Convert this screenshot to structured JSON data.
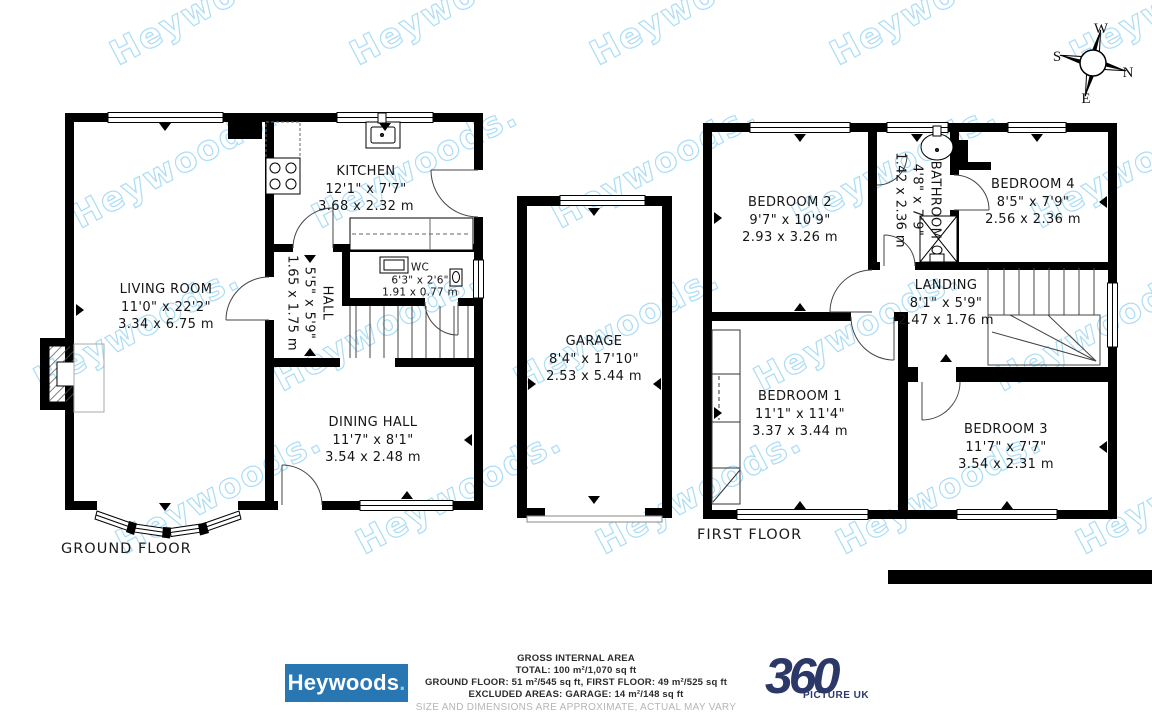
{
  "watermark": {
    "text": "Heywoods.",
    "color": "#aaddf5"
  },
  "compass": {
    "north": "N",
    "east": "E",
    "south": "S",
    "west": "W"
  },
  "ground_floor": {
    "label": "GROUND FLOOR",
    "living_room": {
      "name": "LIVING ROOM",
      "size_imperial": "11'0\" x 22'2\"",
      "size_metric": "3.34 x 6.75 m"
    },
    "kitchen": {
      "name": "KITCHEN",
      "size_imperial": "12'1\" x 7'7\"",
      "size_metric": "3.68 x 2.32 m"
    },
    "hall": {
      "name": "HALL",
      "size_imperial": "5'5\" x 5'9\"",
      "size_metric": "1.65 x 1.75 m"
    },
    "wc": {
      "name": "WC",
      "size_imperial": "6'3\" x 2'6\"",
      "size_metric": "1.91 x 0.77 m"
    },
    "dining_hall": {
      "name": "DINING HALL",
      "size_imperial": "11'7\" x 8'1\"",
      "size_metric": "3.54 x 2.48 m"
    }
  },
  "garage": {
    "name": "GARAGE",
    "size_imperial": "8'4\" x 17'10\"",
    "size_metric": "2.53 x 5.44 m"
  },
  "first_floor": {
    "label": "FIRST FLOOR",
    "bedroom_1": {
      "name": "BEDROOM 1",
      "size_imperial": "11'1\" x 11'4\"",
      "size_metric": "3.37 x 3.44 m"
    },
    "bedroom_2": {
      "name": "BEDROOM 2",
      "size_imperial": "9'7\" x 10'9\"",
      "size_metric": "2.93 x 3.26 m"
    },
    "bedroom_3": {
      "name": "BEDROOM 3",
      "size_imperial": "11'7\" x 7'7\"",
      "size_metric": "3.54 x 2.31 m"
    },
    "bedroom_4": {
      "name": "BEDROOM 4",
      "size_imperial": "8'5\" x 7'9\"",
      "size_metric": "2.56 x 2.36 m"
    },
    "bathroom": {
      "name": "BATHROOM",
      "size_imperial": "4'8\" x 7'9\"",
      "size_metric": "1.42 x 2.36 m"
    },
    "landing": {
      "name": "LANDING",
      "size_imperial": "8'1\" x 5'9\"",
      "size_metric": "2.47 x 1.76 m"
    }
  },
  "footer": {
    "agency_logo": {
      "text": "Heywoods",
      "dot": ".",
      "background": "#2877b3",
      "dot_color": "#7fd1f1"
    },
    "area_summary": {
      "title": "GROSS INTERNAL AREA",
      "total": "TOTAL: 100 m²/1,070 sq ft",
      "floors": "GROUND FLOOR: 51 m²/545 sq ft, FIRST FLOOR: 49 m²/525 sq ft",
      "excluded": "EXCLUDED AREAS: GARAGE: 14 m²/148 sq ft",
      "disclaimer": "SIZE AND DIMENSIONS ARE APPROXIMATE, ACTUAL MAY VARY"
    },
    "photo_logo": {
      "number": "360",
      "sub": "PICTURE UK",
      "color": "#2c3968"
    }
  }
}
